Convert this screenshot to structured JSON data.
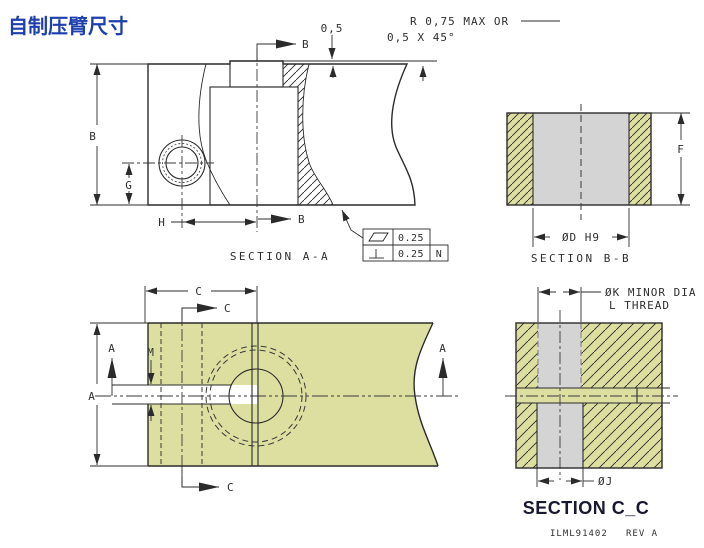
{
  "title": "自制压臂尺寸",
  "colors": {
    "part_fill": "#dcdfa0",
    "insert_fill": "#d4d4d4",
    "line": "#2b2b2b",
    "title": "#1d3fae",
    "section_cc_title": "#181830"
  },
  "notes": {
    "radius_max": "R 0,75 MAX OR",
    "chamfer": "0,5 X 45°",
    "protrusion": "0,5"
  },
  "section_aa": {
    "name": "SECTION A-A",
    "cut_label_top": "B",
    "cut_label_bottom": "B",
    "dim_height": "B",
    "dim_hole_height": "G",
    "dim_hole_offset": "H",
    "fcf": {
      "flatness_value": "0.25",
      "perpendicularity_value": "0.25",
      "datum": "N"
    }
  },
  "section_bb": {
    "name": "SECTION B-B",
    "dim_height": "F",
    "dim_bore": "ØD H9"
  },
  "plan_view": {
    "dim_width": "C",
    "dim_height": "A",
    "dim_slot": "M",
    "cut_label_c_top": "C",
    "cut_label_c_bottom": "C",
    "cut_label_a_left": "A",
    "cut_label_a_right": "A"
  },
  "section_cc": {
    "name": "SECTION C_C",
    "dim_minor": "ØK MINOR DIA",
    "dim_thread": "L THREAD",
    "dim_bore": "ØJ",
    "doc_number": "ILML91402",
    "revision": "REV A"
  }
}
